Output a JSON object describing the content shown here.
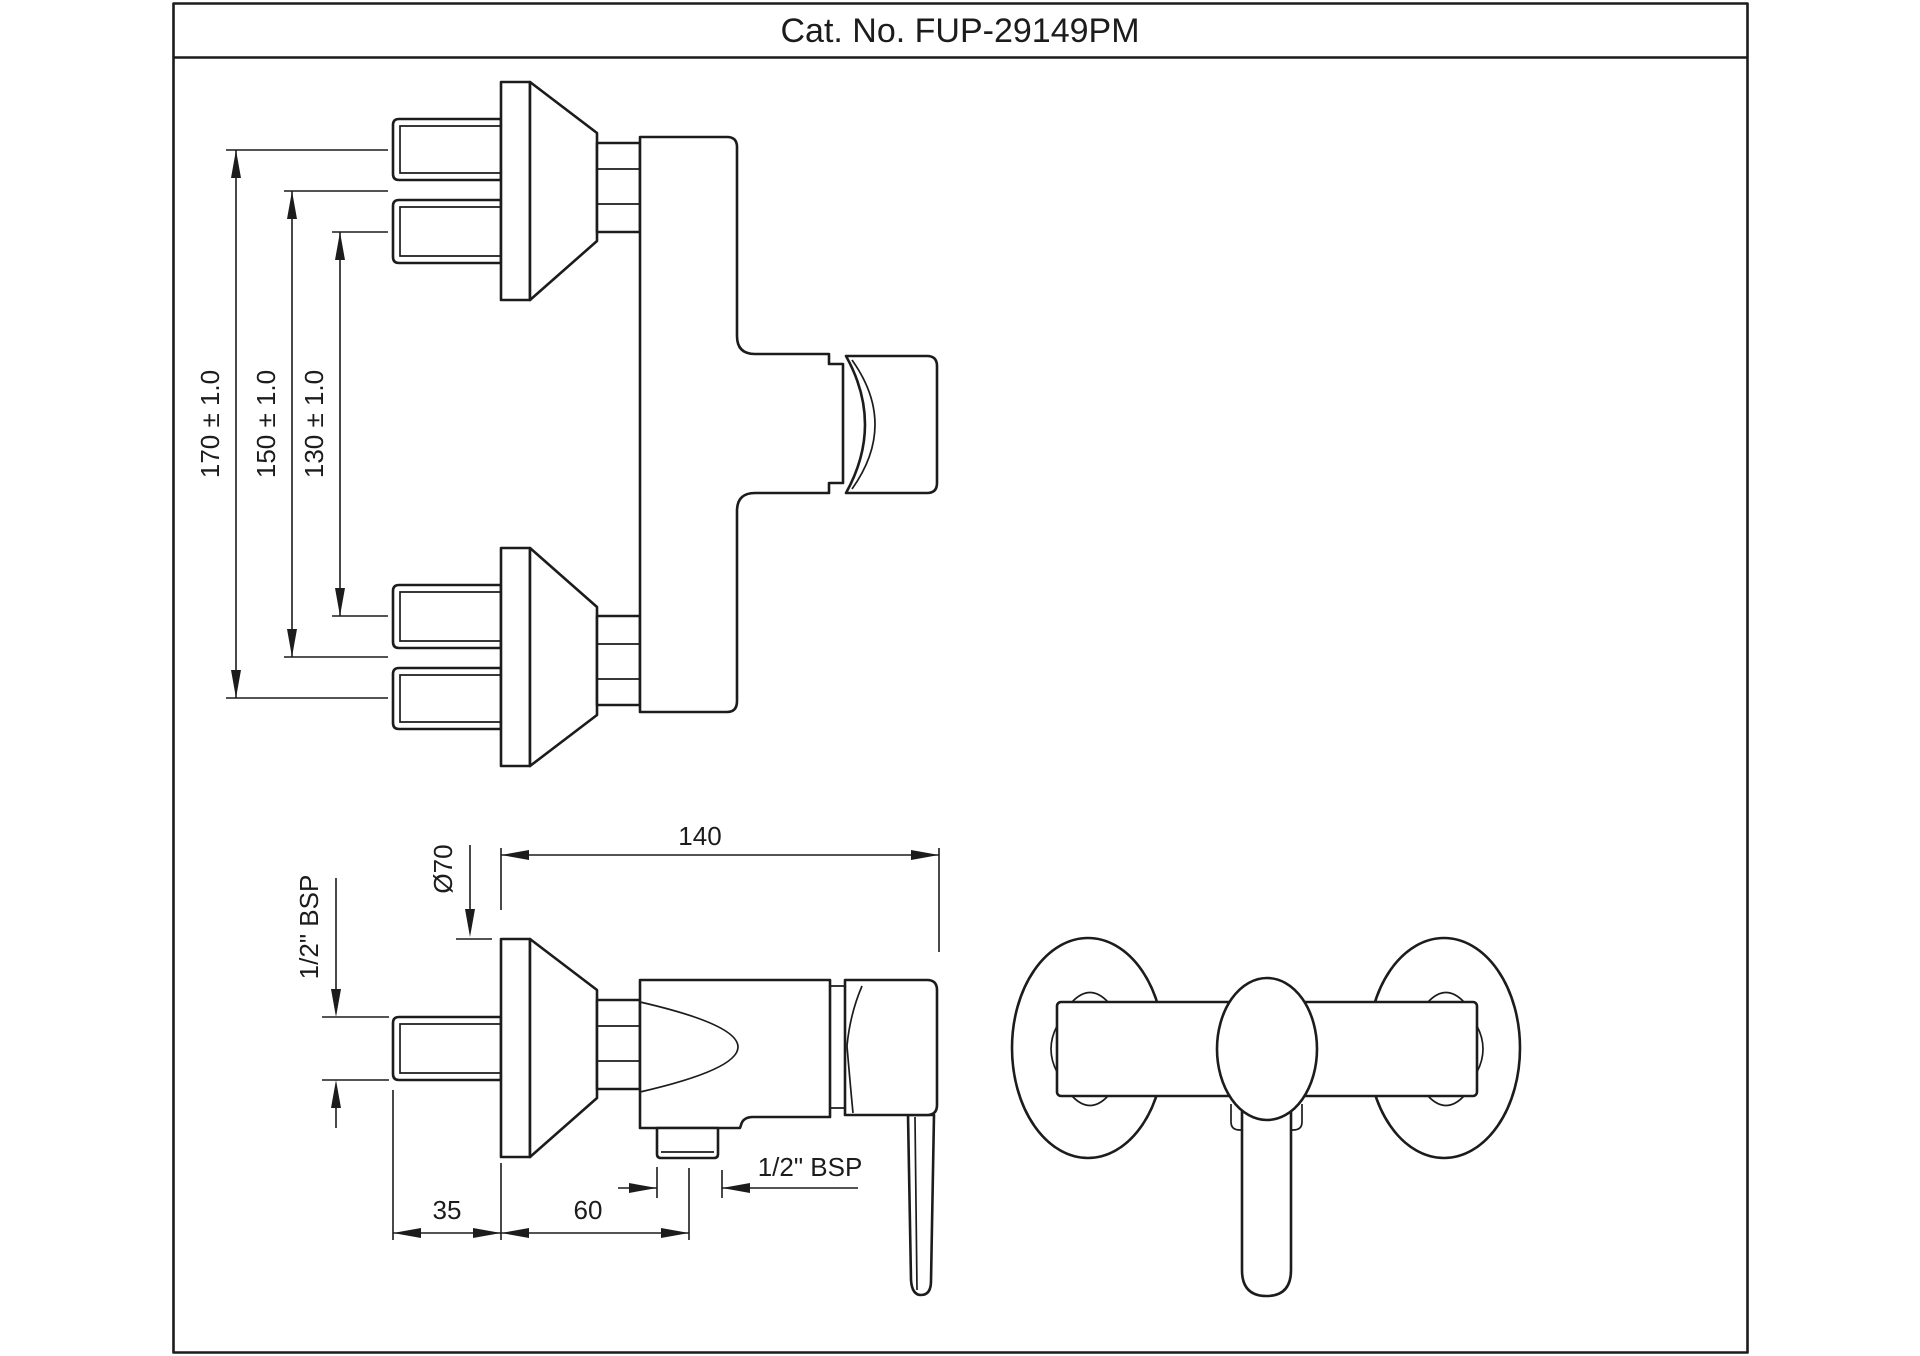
{
  "title": "Cat. No. FUP-29149PM",
  "colors": {
    "line": "#1c1c1c",
    "background": "#ffffff"
  },
  "dimensions": {
    "spacing_170": "170 ± 1.0",
    "spacing_150": "150 ± 1.0",
    "spacing_130": "130 ± 1.0",
    "depth_140": "140",
    "flange_diameter": "Ø70",
    "inlet_thread": "1/2\" BSP",
    "wall_projection_35": "35",
    "outlet_offset_60": "60",
    "outlet_thread": "1/2\" BSP"
  }
}
